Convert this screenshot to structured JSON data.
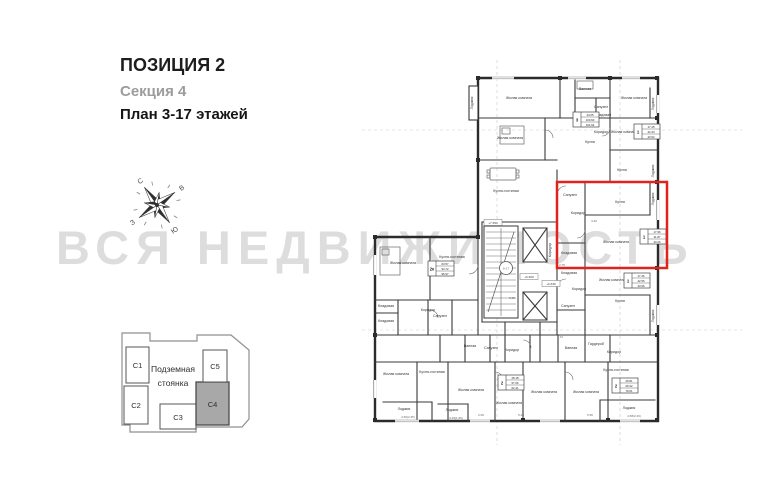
{
  "header": {
    "title": "ПОЗИЦИЯ 2",
    "section": "Секция 4",
    "plan": "План 3-17 этажей"
  },
  "watermark": "ВСЯ НЕДВИЖИМОСТЬ",
  "compass": {
    "north": "С",
    "east": "В",
    "south": "Ю",
    "west": "З"
  },
  "site_plan": {
    "underground_line1": "Подземная",
    "underground_line2": "стоянка",
    "highlighted_section": "С4",
    "sections": [
      {
        "id": "С1"
      },
      {
        "id": "С2"
      },
      {
        "id": "С3"
      },
      {
        "id": "С4"
      },
      {
        "id": "С5"
      }
    ]
  },
  "floor_plan": {
    "highlight_color": "#e0231c",
    "stair_floors": "6-17",
    "levels": [
      {
        "text": "+7.650",
        "x": 493,
        "y": 224
      },
      {
        "text": "+6.600",
        "x": 529,
        "y": 278
      },
      {
        "text": "+6.630",
        "x": 551,
        "y": 285
      }
    ],
    "rooms": [
      {
        "label": "Лоджия",
        "x": 473,
        "y": 103,
        "rot": -90
      },
      {
        "label": "Жилая комната",
        "x": 519,
        "y": 99
      },
      {
        "label": "Ванная",
        "x": 585,
        "y": 90
      },
      {
        "label": "Санузел",
        "x": 601,
        "y": 108
      },
      {
        "label": "Жилая комната",
        "x": 634,
        "y": 99
      },
      {
        "label": "Лоджия",
        "x": 654,
        "y": 104,
        "rot": -90
      },
      {
        "label": "Жилая комната",
        "x": 510,
        "y": 139
      },
      {
        "label": "Кухня",
        "x": 590,
        "y": 143
      },
      {
        "label": "Кладовая",
        "x": 603,
        "y": 116
      },
      {
        "label": "Коридор",
        "x": 601,
        "y": 133
      },
      {
        "label": "Жилая комната",
        "x": 624,
        "y": 133
      },
      {
        "label": "Кухня",
        "x": 622,
        "y": 171
      },
      {
        "label": "Лоджия",
        "x": 654,
        "y": 171,
        "rot": -90
      },
      {
        "label": "Кухня-гостиная",
        "x": 506,
        "y": 192
      },
      {
        "label": "Коридор",
        "x": 551,
        "y": 250,
        "rot": -90
      },
      {
        "label": "Санузел",
        "x": 570,
        "y": 196
      },
      {
        "label": "Коридор",
        "x": 578,
        "y": 214
      },
      {
        "label": "Кухня",
        "x": 620,
        "y": 203
      },
      {
        "label": "Жилая комната",
        "x": 616,
        "y": 243
      },
      {
        "label": "Кладовая",
        "x": 569,
        "y": 254
      },
      {
        "label": "Лоджия",
        "x": 654,
        "y": 199,
        "rot": -90
      },
      {
        "label": "Кладовая",
        "x": 569,
        "y": 274
      },
      {
        "label": "Коридор",
        "x": 579,
        "y": 290
      },
      {
        "label": "Санузел",
        "x": 568,
        "y": 307
      },
      {
        "label": "Жилая комната",
        "x": 612,
        "y": 281
      },
      {
        "label": "Кухня",
        "x": 620,
        "y": 302
      },
      {
        "label": "Лоджия",
        "x": 654,
        "y": 316,
        "rot": -90
      },
      {
        "label": "Жилая комната",
        "x": 403,
        "y": 264
      },
      {
        "label": "Кухня-гостиная",
        "x": 452,
        "y": 258
      },
      {
        "label": "Коридор",
        "x": 428,
        "y": 311
      },
      {
        "label": "Кладовая",
        "x": 386,
        "y": 307
      },
      {
        "label": "Кладовая",
        "x": 386,
        "y": 322
      },
      {
        "label": "Санузел",
        "x": 440,
        "y": 317
      },
      {
        "label": "Ванная",
        "x": 470,
        "y": 347
      },
      {
        "label": "Санузел",
        "x": 491,
        "y": 349
      },
      {
        "label": "Коридор",
        "x": 512,
        "y": 351
      },
      {
        "label": "Ванная",
        "x": 571,
        "y": 349
      },
      {
        "label": "Гардероб",
        "x": 596,
        "y": 345
      },
      {
        "label": "Коридор",
        "x": 614,
        "y": 353
      },
      {
        "label": "Жилая комната",
        "x": 396,
        "y": 375
      },
      {
        "label": "Кухня-гостиная",
        "x": 432,
        "y": 373
      },
      {
        "label": "Жилая комната",
        "x": 471,
        "y": 391
      },
      {
        "label": "Жилая комната",
        "x": 509,
        "y": 404
      },
      {
        "label": "Жилая комната",
        "x": 544,
        "y": 393
      },
      {
        "label": "Жилая комната",
        "x": 586,
        "y": 393
      },
      {
        "label": "Кухня-гостиная",
        "x": 616,
        "y": 371
      },
      {
        "label": "Лоджия",
        "x": 404,
        "y": 410
      },
      {
        "label": "Лоджия",
        "x": 452,
        "y": 411
      },
      {
        "label": "Лоджия",
        "x": 629,
        "y": 409
      }
    ],
    "apartments": [
      {
        "rooms": "3",
        "areas": [
          "44.05",
          "100.60",
          "101.94"
        ],
        "x": 573,
        "y": 112
      },
      {
        "rooms": "1",
        "areas": [
          "17.45",
          "42.33",
          "43.52"
        ],
        "x": 634,
        "y": 124
      },
      {
        "rooms": "1",
        "areas": [
          "17.96",
          "41.87",
          "43.26"
        ],
        "x": 640,
        "y": 229
      },
      {
        "rooms": "1",
        "areas": [
          "17.46",
          "42.56",
          "43.96"
        ],
        "x": 624,
        "y": 273
      },
      {
        "rooms": "2к",
        "areas": [
          "63.57",
          "94.72",
          "96.97"
        ],
        "x": 428,
        "y": 261
      },
      {
        "rooms": "2",
        "areas": [
          "28.18",
          "57.06",
          "62.41"
        ],
        "x": 498,
        "y": 375
      },
      {
        "rooms": "2",
        "areas": [
          "29.81",
          "69.32",
          "79.61"
        ],
        "x": 612,
        "y": 378
      }
    ],
    "dims": [
      {
        "text": "5.68",
        "x": 512,
        "y": 299
      },
      {
        "text": "3.40",
        "x": 594,
        "y": 222
      },
      {
        "text": "2.75",
        "x": 562,
        "y": 266
      },
      {
        "text": "5.20",
        "x": 521,
        "y": 416
      },
      {
        "text": "2.06",
        "x": 481,
        "y": 416
      },
      {
        "text": "5.56",
        "x": 590,
        "y": 416
      },
      {
        "text": "3.72",
        "x": 560,
        "y": 338
      },
      {
        "text": "4.69(2.35)",
        "x": 408,
        "y": 418
      },
      {
        "text": "3.29(1.65)",
        "x": 456,
        "y": 419
      },
      {
        "text": "4.58(2.29)",
        "x": 634,
        "y": 417
      }
    ]
  }
}
